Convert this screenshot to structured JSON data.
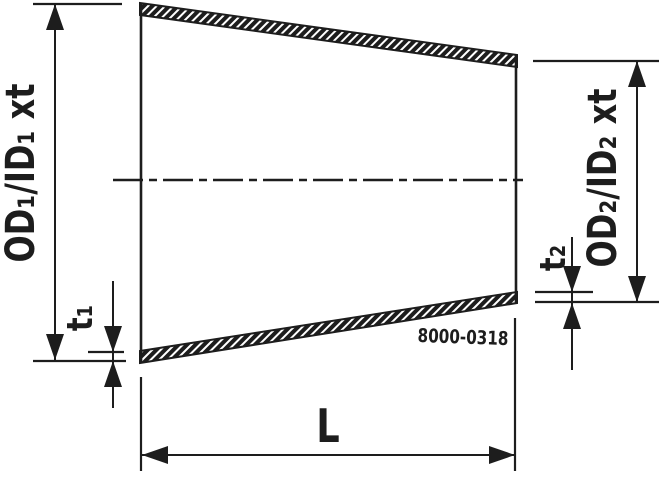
{
  "drawing": {
    "part_number": "8000-0318",
    "dimensions": {
      "large_end_diameter": "OD₁/ID₁ xt",
      "small_end_diameter": "OD₂/ID₂ xt",
      "large_end_wall_thickness": "t₁",
      "small_end_wall_thickness": "t₂",
      "length": "L"
    },
    "colors": {
      "line": "#1d1d1d",
      "background": "#ffffff"
    }
  }
}
